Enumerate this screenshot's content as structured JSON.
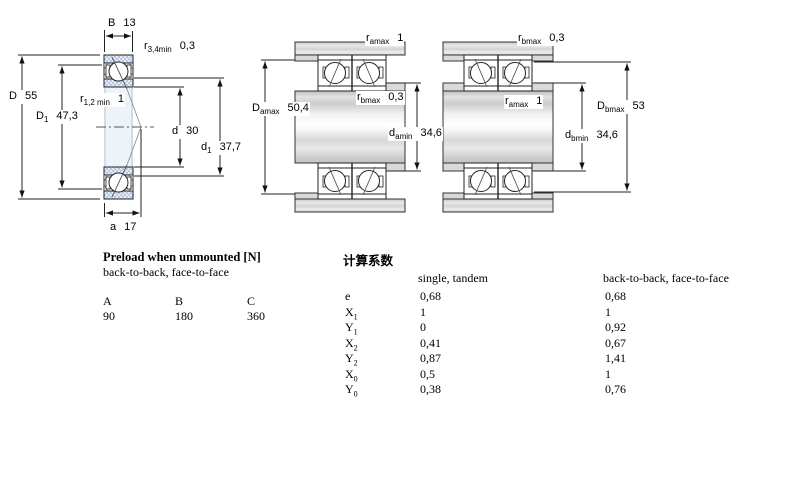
{
  "figure": {
    "left_section_view": {
      "labels": {
        "B": {
          "sym": "B",
          "sub": "",
          "val": "13"
        },
        "r34": {
          "sym": "r",
          "sub": "3,4min",
          "val": "0,3"
        },
        "D": {
          "sym": "D",
          "sub": "",
          "val": "55"
        },
        "D1": {
          "sym": "D",
          "sub": "1",
          "val": "47,3"
        },
        "r12": {
          "sym": "r",
          "sub": "1,2 min",
          "val": "1"
        },
        "d": {
          "sym": "d",
          "sub": "",
          "val": "30"
        },
        "d1": {
          "sym": "d",
          "sub": "1",
          "val": "37,7"
        },
        "a": {
          "sym": "a",
          "sub": "",
          "val": "17"
        }
      }
    },
    "middle_mounted_view": {
      "labels": {
        "ramax": {
          "sym": "r",
          "sub": "amax",
          "val": "1"
        },
        "rbmax": {
          "sym": "r",
          "sub": "bmax",
          "val": "0,3"
        },
        "Damax": {
          "sym": "D",
          "sub": "amax",
          "val": "50,4"
        },
        "damin": {
          "sym": "d",
          "sub": "amin",
          "val": "34,6"
        }
      }
    },
    "right_mounted_view": {
      "labels": {
        "rbmax": {
          "sym": "r",
          "sub": "bmax",
          "val": "0,3"
        },
        "ramax": {
          "sym": "r",
          "sub": "amax",
          "val": "1"
        },
        "Dbmax": {
          "sym": "D",
          "sub": "bmax",
          "val": "53"
        },
        "dbmin": {
          "sym": "d",
          "sub": "bmin",
          "val": "34,6"
        }
      }
    },
    "colors": {
      "ring_hatch_blue": "#b9c9e4",
      "metal_gray": "#d5d5d5",
      "line_black": "#222222"
    }
  },
  "preload": {
    "title": "Preload when unmounted [N]",
    "subtitle": "back-to-back, face-to-face",
    "headers": [
      "A",
      "B",
      "C"
    ],
    "values": [
      "90",
      "180",
      "360"
    ]
  },
  "factors": {
    "title": "计算系数",
    "col1_header": "single, tandem",
    "col2_header": "back-to-back, face-to-face",
    "rows": [
      {
        "sym": "e",
        "sub": "",
        "v1": "0,68",
        "v2": "0,68"
      },
      {
        "sym": "X",
        "sub": "1",
        "v1": "1",
        "v2": "1"
      },
      {
        "sym": "Y",
        "sub": "1",
        "v1": "0",
        "v2": "0,92"
      },
      {
        "sym": "X",
        "sub": "2",
        "v1": "0,41",
        "v2": "0,67"
      },
      {
        "sym": "Y",
        "sub": "2",
        "v1": "0,87",
        "v2": "1,41"
      },
      {
        "sym": "X",
        "sub": "0",
        "v1": "0,5",
        "v2": "1"
      },
      {
        "sym": "Y",
        "sub": "0",
        "v1": "0,38",
        "v2": "0,76"
      }
    ]
  }
}
